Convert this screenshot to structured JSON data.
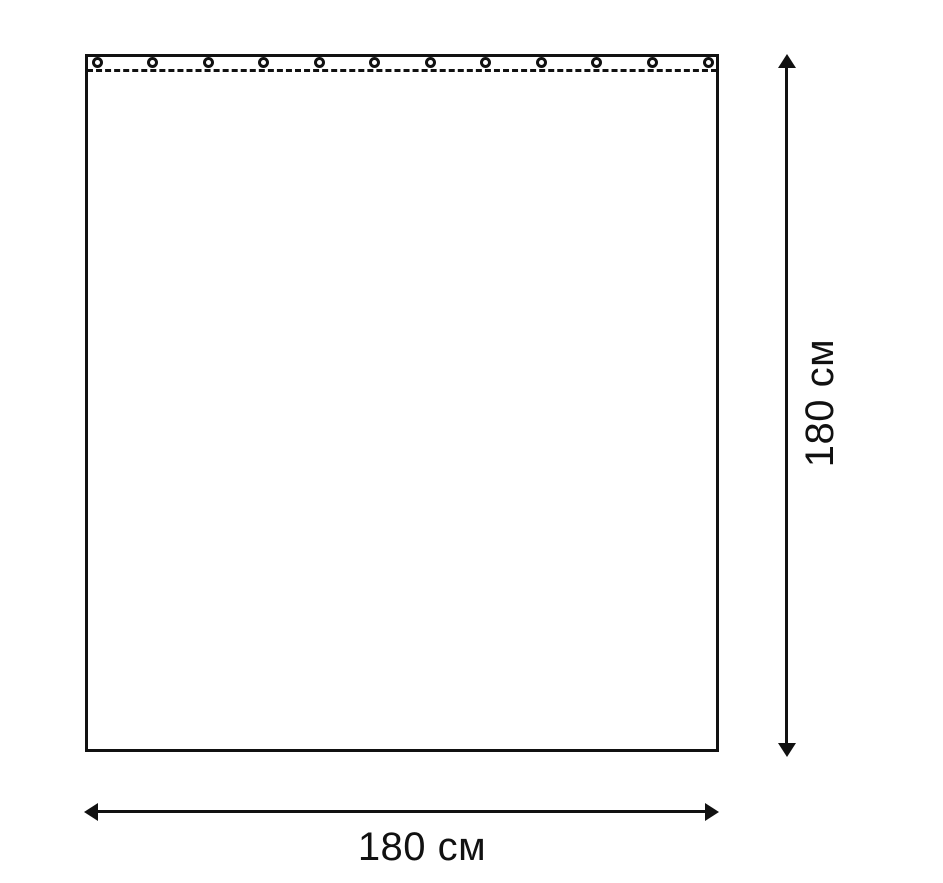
{
  "diagram": {
    "kind": "product-dimension-diagram",
    "subject": "curtain-panel-with-grommets",
    "width_dimension": {
      "label": "180 см"
    },
    "height_dimension": {
      "label": "180 см"
    },
    "grommets": {
      "count": 12
    },
    "stitch_line": {
      "style": "dashed"
    },
    "colors": {
      "line": "#111111",
      "background": "#ffffff"
    }
  }
}
